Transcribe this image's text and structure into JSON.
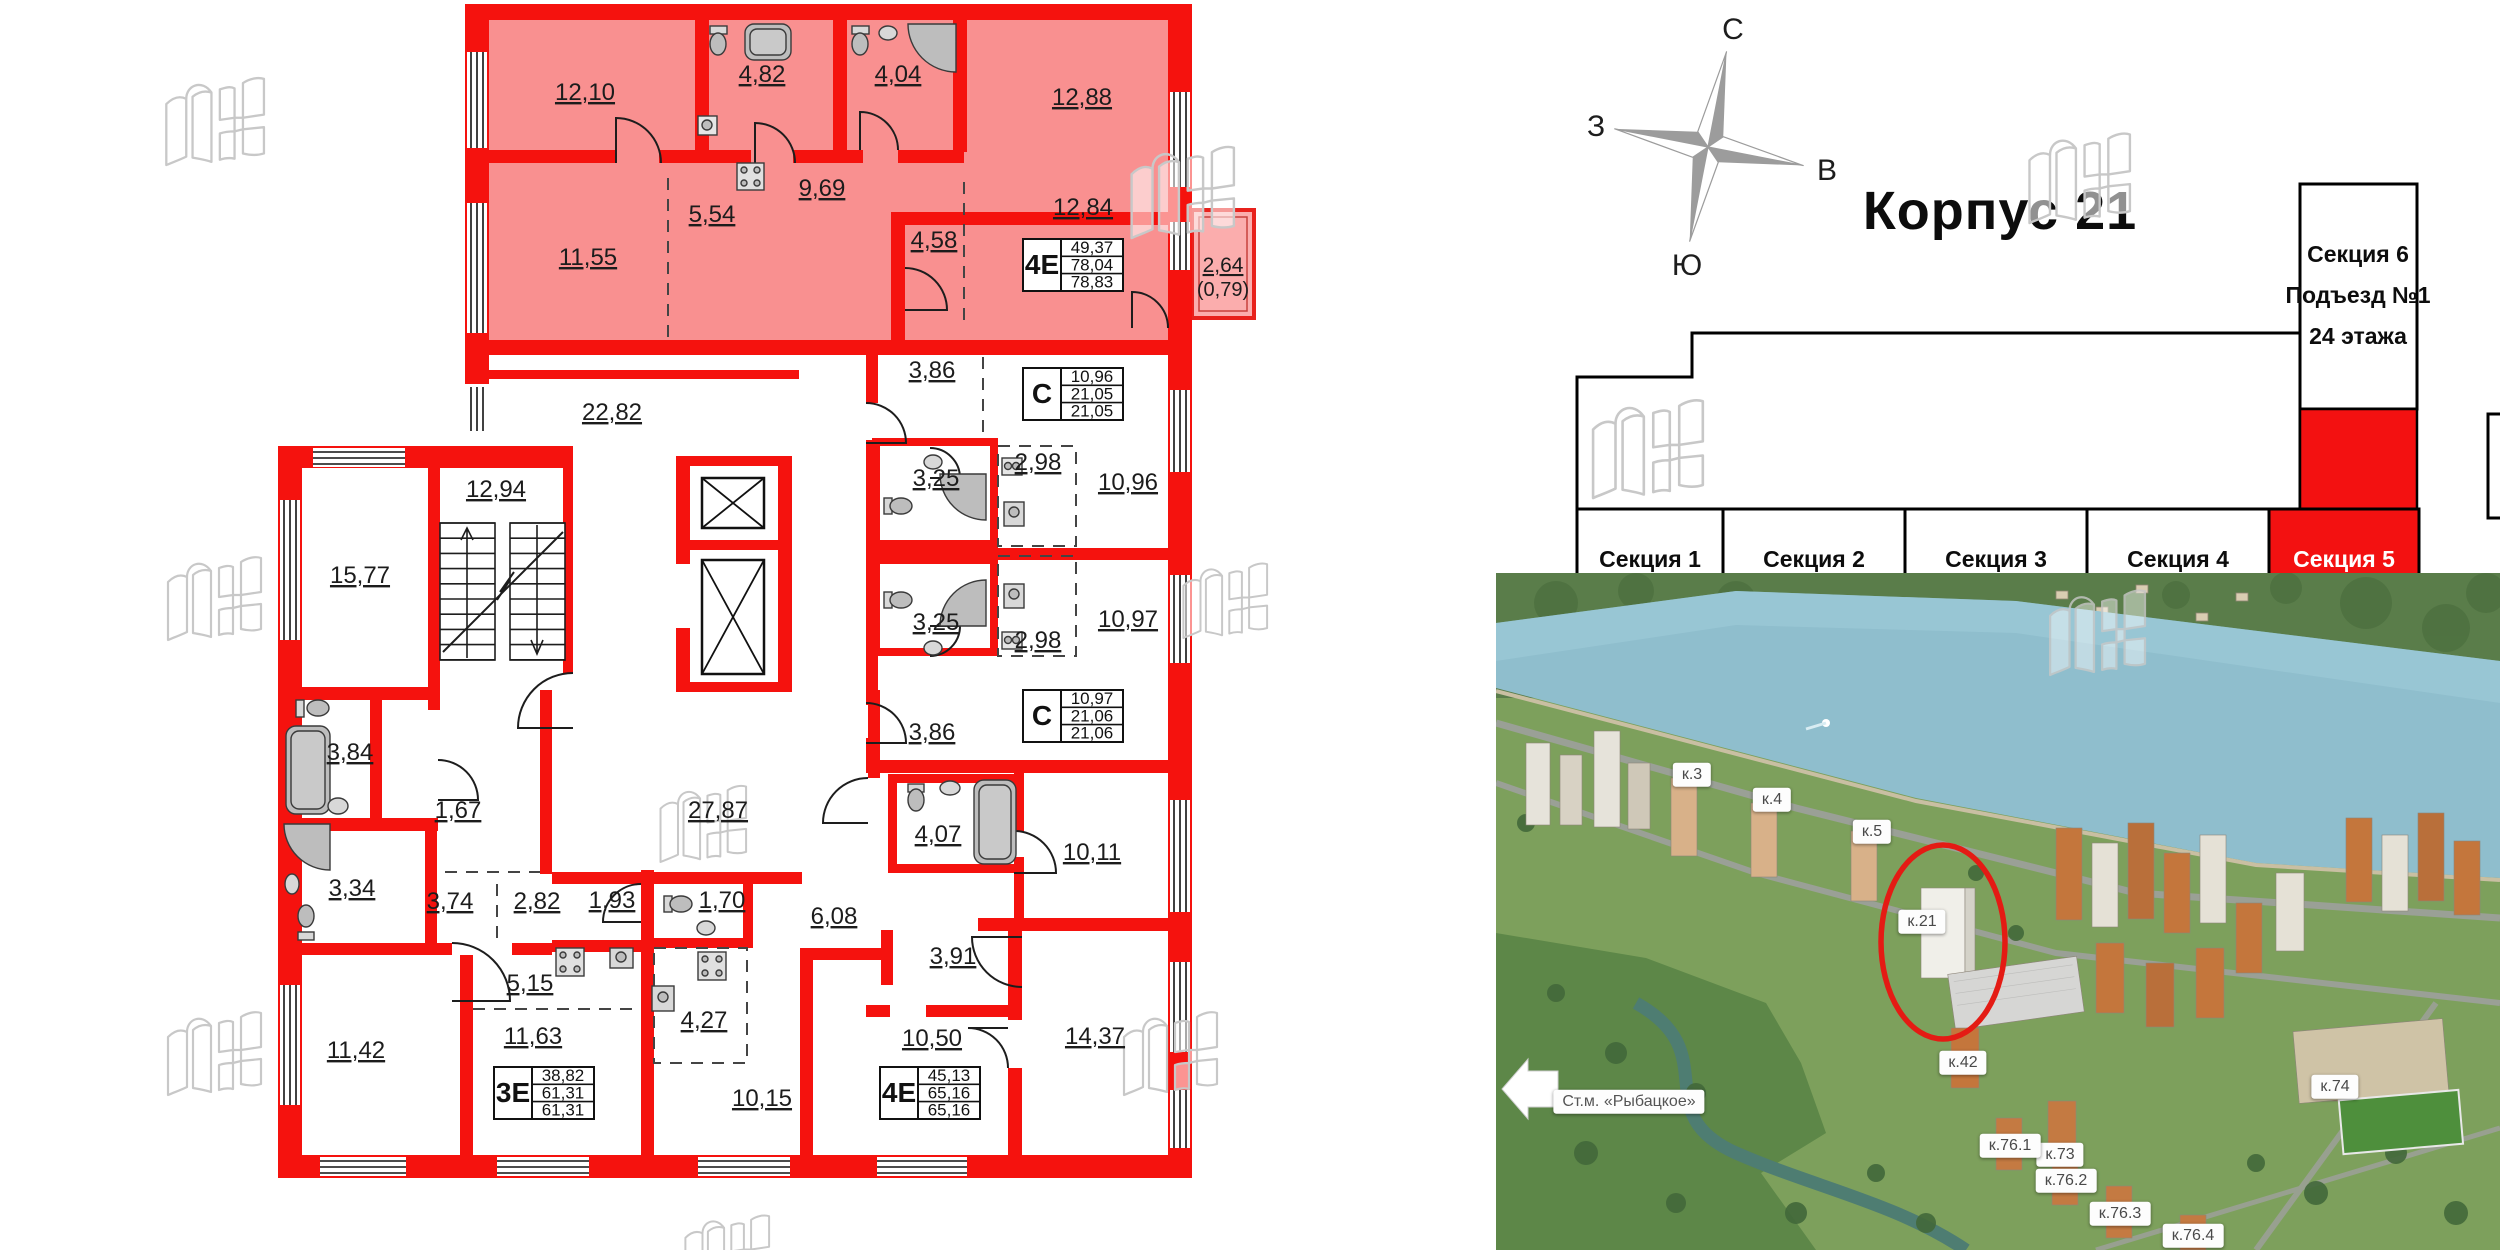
{
  "floor_plan": {
    "rooms": [
      {
        "t": "12,10",
        "x": 585,
        "y": 100
      },
      {
        "t": "4,82",
        "x": 762,
        "y": 82
      },
      {
        "t": "4,04",
        "x": 898,
        "y": 82
      },
      {
        "t": "12,88",
        "x": 1082,
        "y": 105
      },
      {
        "t": "5,54",
        "x": 712,
        "y": 222
      },
      {
        "t": "9,69",
        "x": 822,
        "y": 196
      },
      {
        "t": "11,55",
        "x": 588,
        "y": 265
      },
      {
        "t": "4,58",
        "x": 934,
        "y": 248
      },
      {
        "t": "12,84",
        "x": 1083,
        "y": 215
      },
      {
        "t": "2,64",
        "x": 1223,
        "y": 272,
        "fs": 21
      },
      {
        "t": "(0,79)",
        "x": 1223,
        "y": 296,
        "u": 0,
        "fs": 20
      },
      {
        "t": "22,82",
        "x": 612,
        "y": 420
      },
      {
        "t": "12,94",
        "x": 496,
        "y": 497
      },
      {
        "t": "3,86",
        "x": 932,
        "y": 378
      },
      {
        "t": "2,98",
        "x": 1038,
        "y": 470
      },
      {
        "t": "3,25",
        "x": 936,
        "y": 486
      },
      {
        "t": "10,96",
        "x": 1128,
        "y": 490
      },
      {
        "t": "3,25",
        "x": 936,
        "y": 630
      },
      {
        "t": "2,98",
        "x": 1038,
        "y": 648
      },
      {
        "t": "10,97",
        "x": 1128,
        "y": 627
      },
      {
        "t": "3,86",
        "x": 932,
        "y": 740
      },
      {
        "t": "15,77",
        "x": 360,
        "y": 583
      },
      {
        "t": "3,84",
        "x": 350,
        "y": 760
      },
      {
        "t": "1,67",
        "x": 458,
        "y": 818
      },
      {
        "t": "3,34",
        "x": 352,
        "y": 896
      },
      {
        "t": "3,74",
        "x": 450,
        "y": 909
      },
      {
        "t": "2,82",
        "x": 537,
        "y": 909
      },
      {
        "t": "27,87",
        "x": 718,
        "y": 818
      },
      {
        "t": "1,93",
        "x": 612,
        "y": 908
      },
      {
        "t": "1,70",
        "x": 722,
        "y": 908
      },
      {
        "t": "6,08",
        "x": 834,
        "y": 924
      },
      {
        "t": "4,07",
        "x": 938,
        "y": 842
      },
      {
        "t": "3,91",
        "x": 953,
        "y": 964
      },
      {
        "t": "10,11",
        "x": 1092,
        "y": 860
      },
      {
        "t": "5,15",
        "x": 530,
        "y": 991
      },
      {
        "t": "11,63",
        "x": 533,
        "y": 1044
      },
      {
        "t": "11,42",
        "x": 356,
        "y": 1058
      },
      {
        "t": "4,27",
        "x": 704,
        "y": 1028
      },
      {
        "t": "10,15",
        "x": 762,
        "y": 1106
      },
      {
        "t": "10,50",
        "x": 932,
        "y": 1046
      },
      {
        "t": "14,37",
        "x": 1095,
        "y": 1044
      }
    ],
    "stamps": [
      {
        "type": "4Е",
        "values": [
          "49,37",
          "78,04",
          "78,83"
        ],
        "x": 1023,
        "y": 239
      },
      {
        "type": "С",
        "values": [
          "10,96",
          "21,05",
          "21,05"
        ],
        "x": 1023,
        "y": 368
      },
      {
        "type": "С",
        "values": [
          "10,97",
          "21,06",
          "21,06"
        ],
        "x": 1023,
        "y": 690
      },
      {
        "type": "3Е",
        "values": [
          "38,82",
          "61,31",
          "61,31"
        ],
        "x": 494,
        "y": 1067
      },
      {
        "type": "4Е",
        "values": [
          "45,13",
          "65,16",
          "65,16"
        ],
        "x": 880,
        "y": 1067
      }
    ]
  },
  "right_panel": {
    "compass": {
      "north": "С",
      "west": "З",
      "east": "В",
      "south": "Ю"
    },
    "title": "Корпус 21",
    "parking": "Паркинг 2 уровня",
    "sections": [
      {
        "name": "Секция 1",
        "entrance": "Подъезд №6",
        "floors": "14 этажей",
        "highlight": false
      },
      {
        "name": "Секция 2",
        "entrance": "Подъезд №5",
        "floors": "16 этажей",
        "highlight": false
      },
      {
        "name": "Секция 3",
        "entrance": "Подъезд №4",
        "floors": "16 этажей",
        "highlight": false
      },
      {
        "name": "Секция 4",
        "entrance": "Подъезд №3",
        "floors": "24 этажа",
        "highlight": false
      },
      {
        "name": "Секция 5",
        "entrance": "Подъезд №2",
        "floors": "24 этажа",
        "highlight": true
      },
      {
        "name": "Секция 6",
        "entrance": "Подъезд №1",
        "floors": "24 этажа",
        "highlight": false,
        "tower": true
      }
    ]
  },
  "photo": {
    "labels": [
      {
        "t": "к.3",
        "x": 196,
        "y": 202
      },
      {
        "t": "к.4",
        "x": 276,
        "y": 227
      },
      {
        "t": "к.5",
        "x": 376,
        "y": 259
      },
      {
        "t": "к.21",
        "x": 426,
        "y": 349
      },
      {
        "t": "к.42",
        "x": 467,
        "y": 490
      },
      {
        "t": "к.73",
        "x": 564,
        "y": 582
      },
      {
        "t": "к.74",
        "x": 839,
        "y": 514
      },
      {
        "t": "к.76.1",
        "x": 514,
        "y": 573
      },
      {
        "t": "к.76.2",
        "x": 570,
        "y": 608
      },
      {
        "t": "к.76.3",
        "x": 624,
        "y": 641
      },
      {
        "t": "к.76.4",
        "x": 697,
        "y": 663
      }
    ],
    "metro": "Ст.м. «Рыбацкое»",
    "highlighted": "к.21",
    "colors": {
      "circle": "#e41b14",
      "water": "#8fbecd",
      "park": "#6a9150"
    }
  }
}
